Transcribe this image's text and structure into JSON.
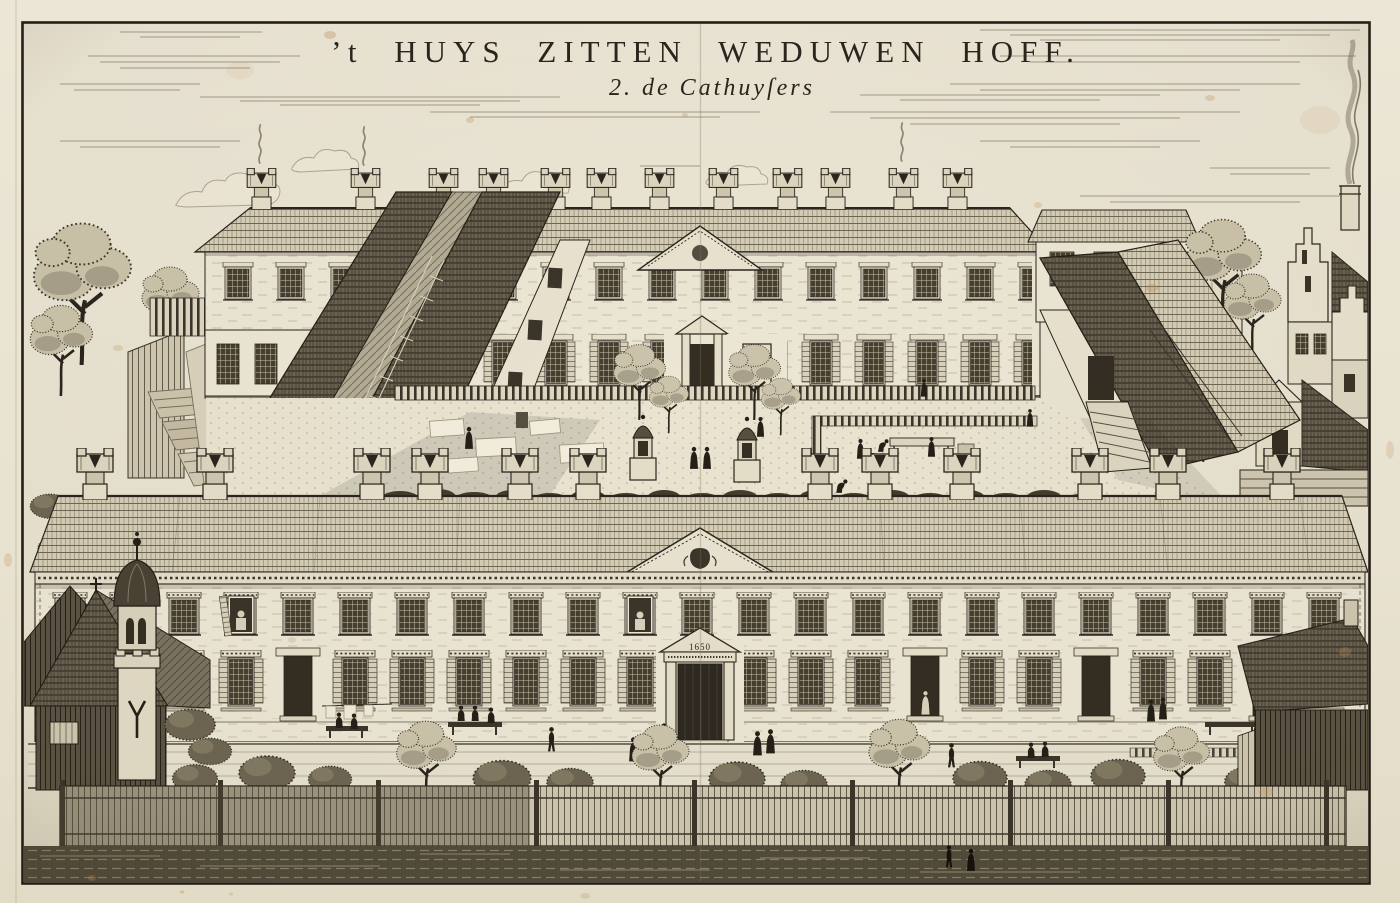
{
  "artwork": {
    "title": "’t HUYS ZITTEN WEDUWEN HOFF.",
    "subtitle": "2. de Cathuyſers",
    "door_date_inscription": "1650"
  },
  "palette": {
    "paper": "#e9e3d2",
    "ink": "#2a251d",
    "ink_light": "#7d7460",
    "foxing": "#b98e55"
  }
}
